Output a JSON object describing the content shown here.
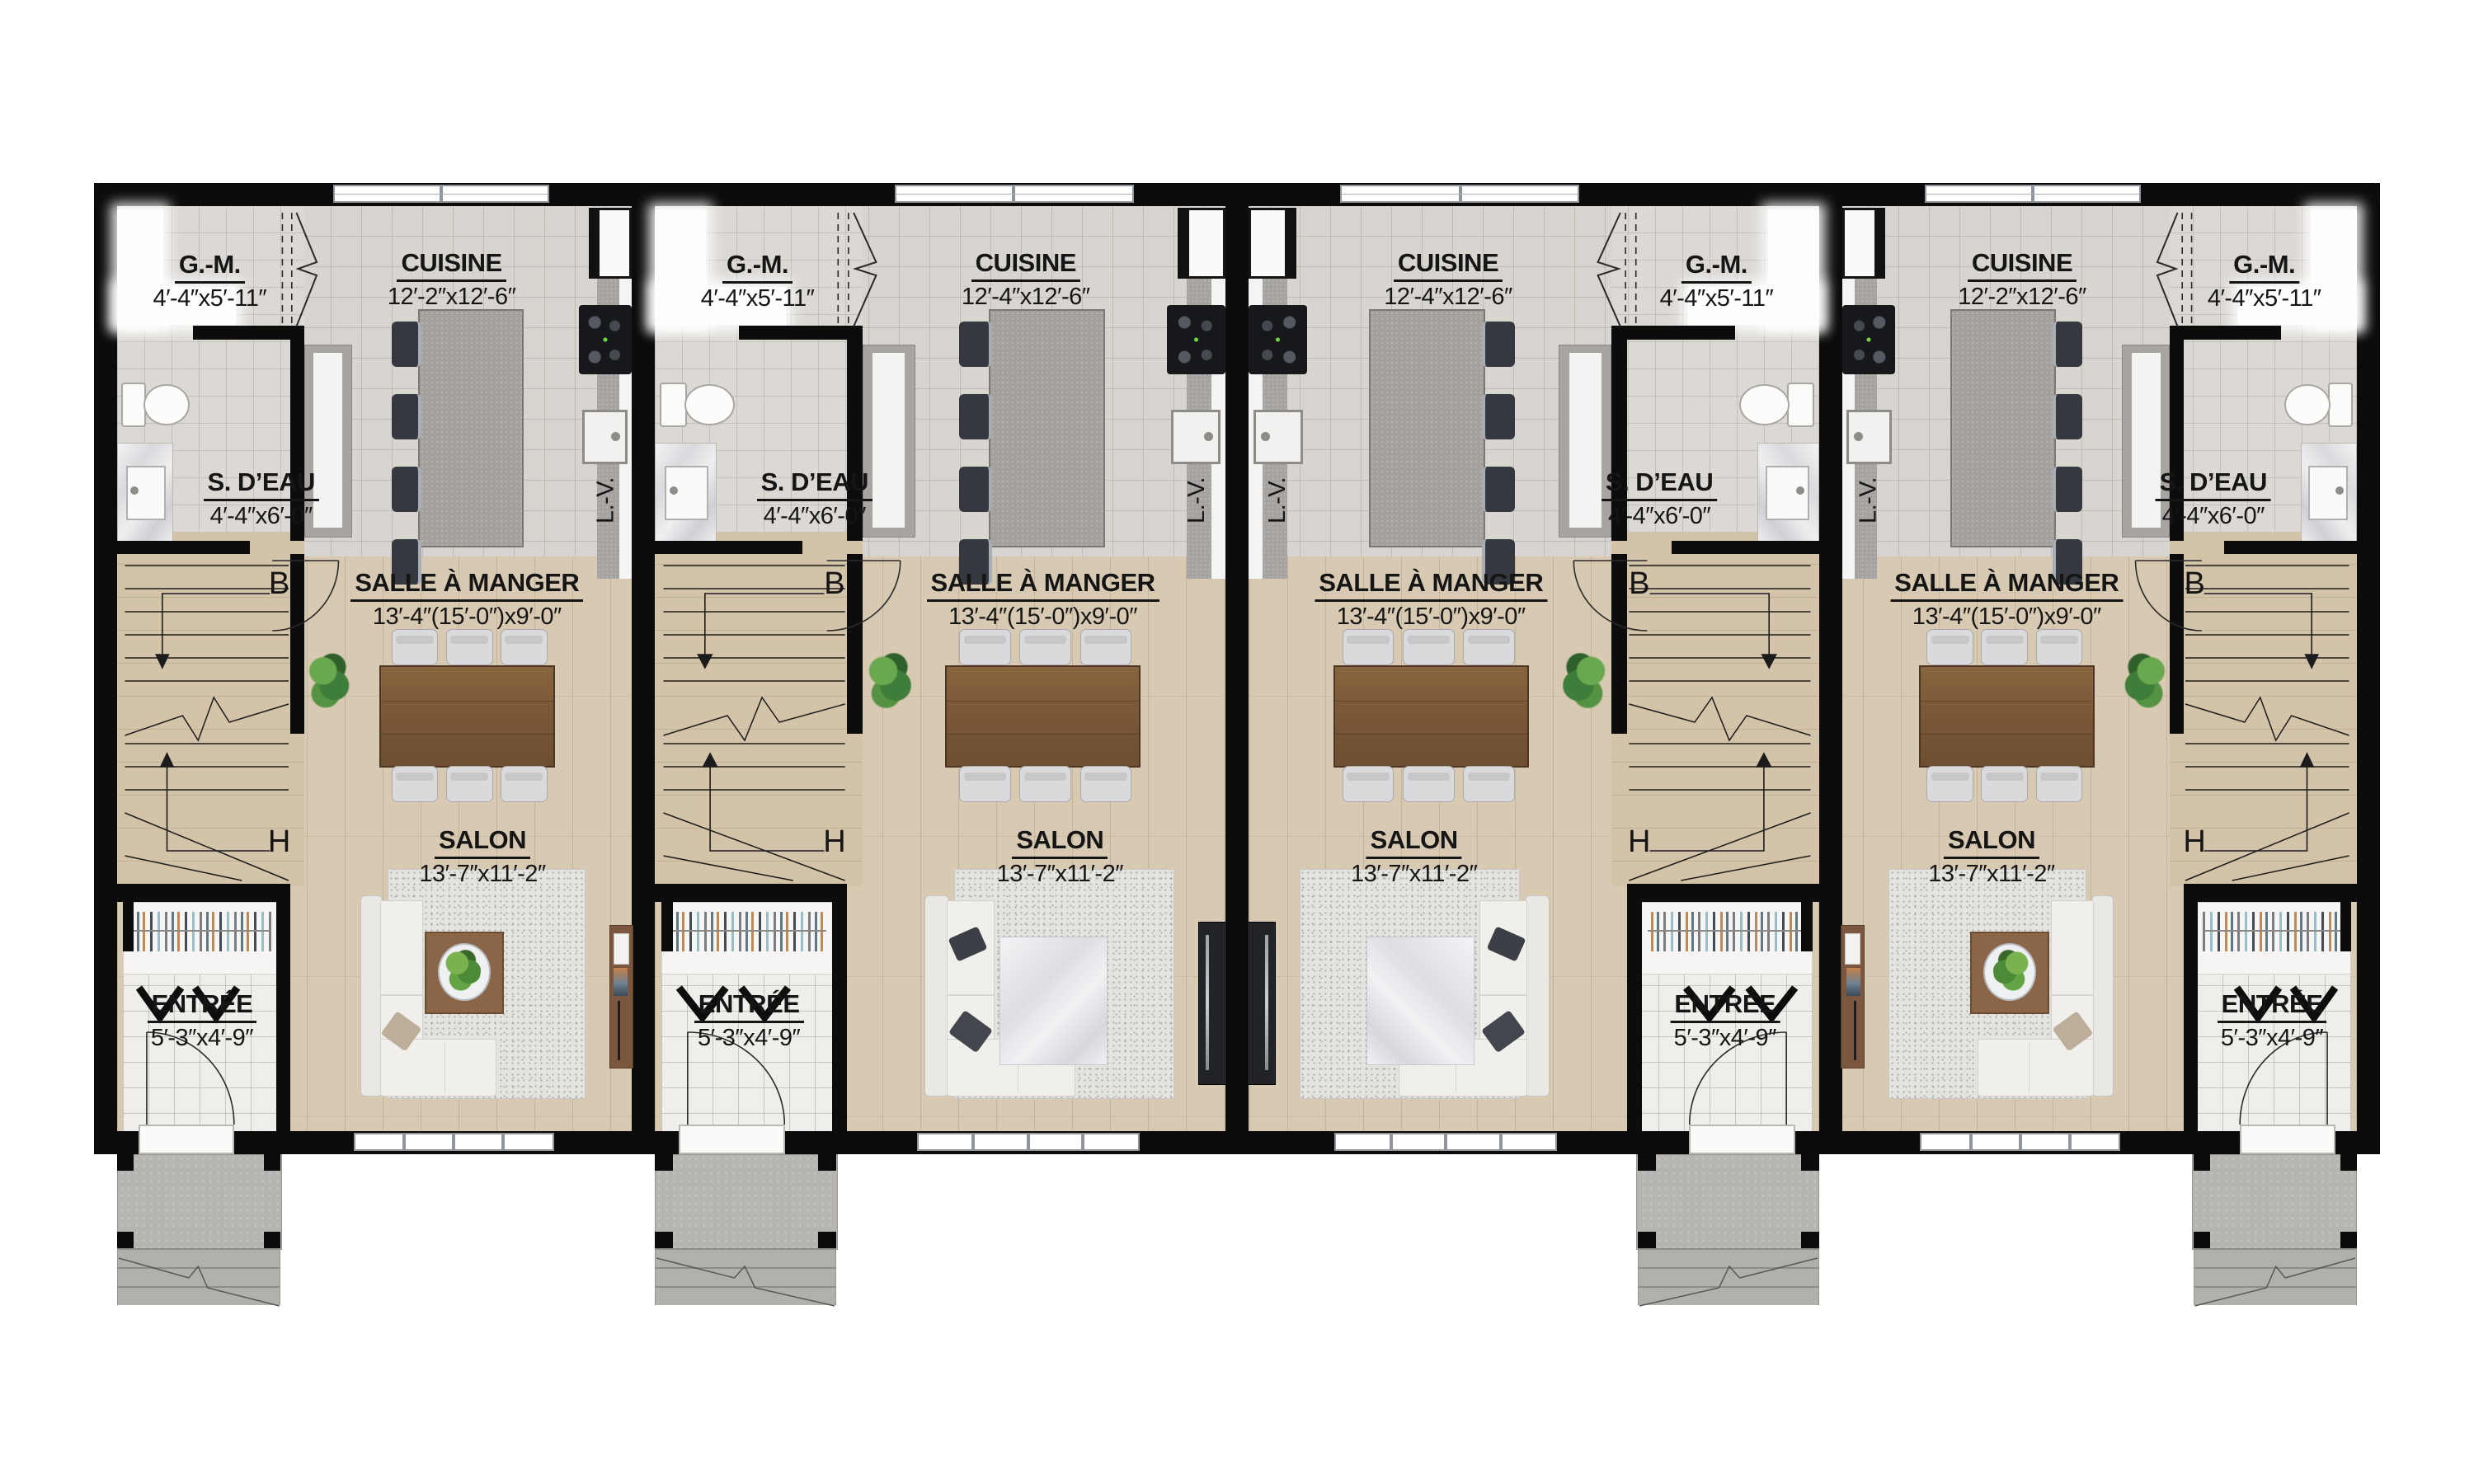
{
  "document": {
    "type": "architectural-floor-plan",
    "level": "rez-de-chaussée (4 unités en rangée)",
    "language": "fr"
  },
  "colors": {
    "wall": "#0b0b0b",
    "tile_floor": "#d8d5d0",
    "wood_floor": "#d8cab2",
    "island": "#a3a09d",
    "porch_concrete": "#b7b5b2",
    "table_wood": "#7a5838",
    "plant_green": "#5d9a44",
    "text": "#151515"
  },
  "units": [
    {
      "id": "unit-1",
      "mirrored": false,
      "variant": "A",
      "gm_label": "G.-M.",
      "gm_dim": "4′-4″x5′-11″",
      "cuisine_label": "CUISINE",
      "cuisine_dim": "12′-2″x12′-6″",
      "sdeau_label": "S. D’EAU",
      "sdeau_dim": "4′-4″x6′-0″",
      "dining_label": "SALLE À MANGER",
      "dining_dim": "13′-4″(15′-0″)x9′-0″",
      "salon_label": "SALON",
      "salon_dim": "13′-7″x11′-2″",
      "entree_label": "ENTRÉE",
      "entree_dim": "5′-3″x4′-9″",
      "stair_down": "B",
      "stair_up": "H",
      "dishwasher": "L.-V."
    },
    {
      "id": "unit-2",
      "mirrored": false,
      "variant": "B",
      "gm_label": "G.-M.",
      "gm_dim": "4′-4″x5′-11″",
      "cuisine_label": "CUISINE",
      "cuisine_dim": "12′-4″x12′-6″",
      "sdeau_label": "S. D’EAU",
      "sdeau_dim": "4′-4″x6′-0″",
      "dining_label": "SALLE À MANGER",
      "dining_dim": "13′-4″(15′-0″)x9′-0″",
      "salon_label": "SALON",
      "salon_dim": "13′-7″x11′-2″",
      "entree_label": "ENTRÉE",
      "entree_dim": "5′-3″x4′-9″",
      "stair_down": "B",
      "stair_up": "H",
      "dishwasher": "L.-V."
    },
    {
      "id": "unit-3",
      "mirrored": true,
      "variant": "B",
      "gm_label": "G.-M.",
      "gm_dim": "4′-4″x5′-11″",
      "cuisine_label": "CUISINE",
      "cuisine_dim": "12′-4″x12′-6″",
      "sdeau_label": "S. D’EAU",
      "sdeau_dim": "4′-4″x6′-0″",
      "dining_label": "SALLE À MANGER",
      "dining_dim": "13′-4″(15′-0″)x9′-0″",
      "salon_label": "SALON",
      "salon_dim": "13′-7″x11′-2″",
      "entree_label": "ENTRÉE",
      "entree_dim": "5′-3″x4′-9″",
      "stair_down": "B",
      "stair_up": "H",
      "dishwasher": "L.-V."
    },
    {
      "id": "unit-4",
      "mirrored": true,
      "variant": "A",
      "gm_label": "G.-M.",
      "gm_dim": "4′-4″x5′-11″",
      "cuisine_label": "CUISINE",
      "cuisine_dim": "12′-2″x12′-6″",
      "sdeau_label": "S. D’EAU",
      "sdeau_dim": "4′-4″x6′-0″",
      "dining_label": "SALLE À MANGER",
      "dining_dim": "13′-4″(15′-0″)x9′-0″",
      "salon_label": "SALON",
      "salon_dim": "13′-7″x11′-2″",
      "entree_label": "ENTRÉE",
      "entree_dim": "5′-3″x4′-9″",
      "stair_down": "B",
      "stair_up": "H",
      "dishwasher": "L.-V."
    }
  ]
}
